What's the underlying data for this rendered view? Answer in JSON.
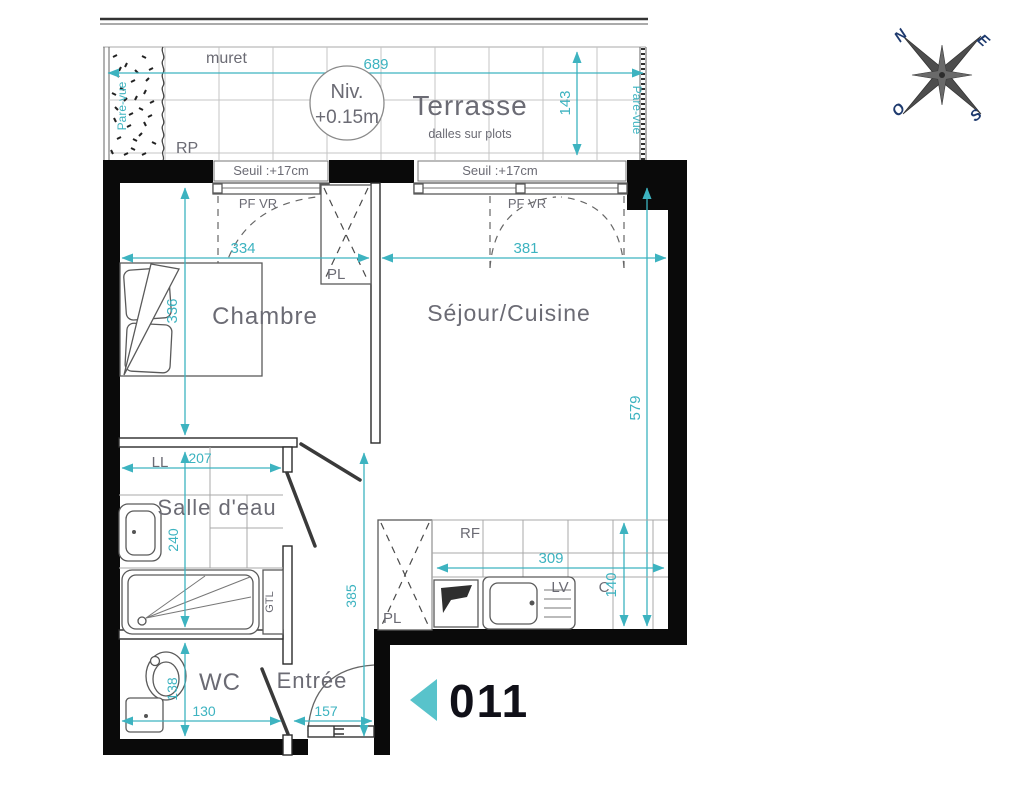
{
  "plan": {
    "unit": {
      "number": "011"
    },
    "compass": {
      "n": "N",
      "e": "E",
      "s": "S",
      "o": "O"
    },
    "terrace": {
      "label": "Terrasse",
      "sub_label": "dalles sur plots",
      "muret_label": "muret",
      "rp_label": "RP",
      "level_line1": "Niv.",
      "level_line2": "+0.15m",
      "pare_vue_left": "Pare-vue",
      "pare_vue_right": "Pare-vue"
    },
    "rooms": {
      "chambre": "Chambre",
      "sejour": "Séjour/Cuisine",
      "salle_deau": "Salle d'eau",
      "wc": "WC",
      "entree": "Entrée"
    },
    "fixtures": {
      "pl_chambre": "PL",
      "pl_cuisine": "PL",
      "ll": "LL",
      "gtl": "GTL",
      "rf": "RF",
      "lv": "LV",
      "c": "C"
    },
    "windows": {
      "seuil_left": "Seuil :+17cm",
      "seuil_right": "Seuil :+17cm",
      "pf_vr_left": "PF VR",
      "pf_vr_right": "PF VR"
    },
    "dimensions": {
      "terrace_width": "689",
      "terrace_depth": "143",
      "chambre_width": "334",
      "sejour_width": "381",
      "chambre_depth": "336",
      "sejour_depth": "579",
      "salle_deau_width": "207",
      "salle_deau_depth": "240",
      "hall_depth": "385",
      "kitchen_width": "309",
      "kitchen_depth": "140",
      "wc_width": "130",
      "wc_depth": "138",
      "entree_width": "157"
    },
    "colors": {
      "dimension_teal": "#3db3c0",
      "unit_arrow_teal": "#58c3cb",
      "label_gray": "#6b6b74",
      "wall_black": "#0a0a0a",
      "compass_navy": "#1e3a6e"
    }
  }
}
